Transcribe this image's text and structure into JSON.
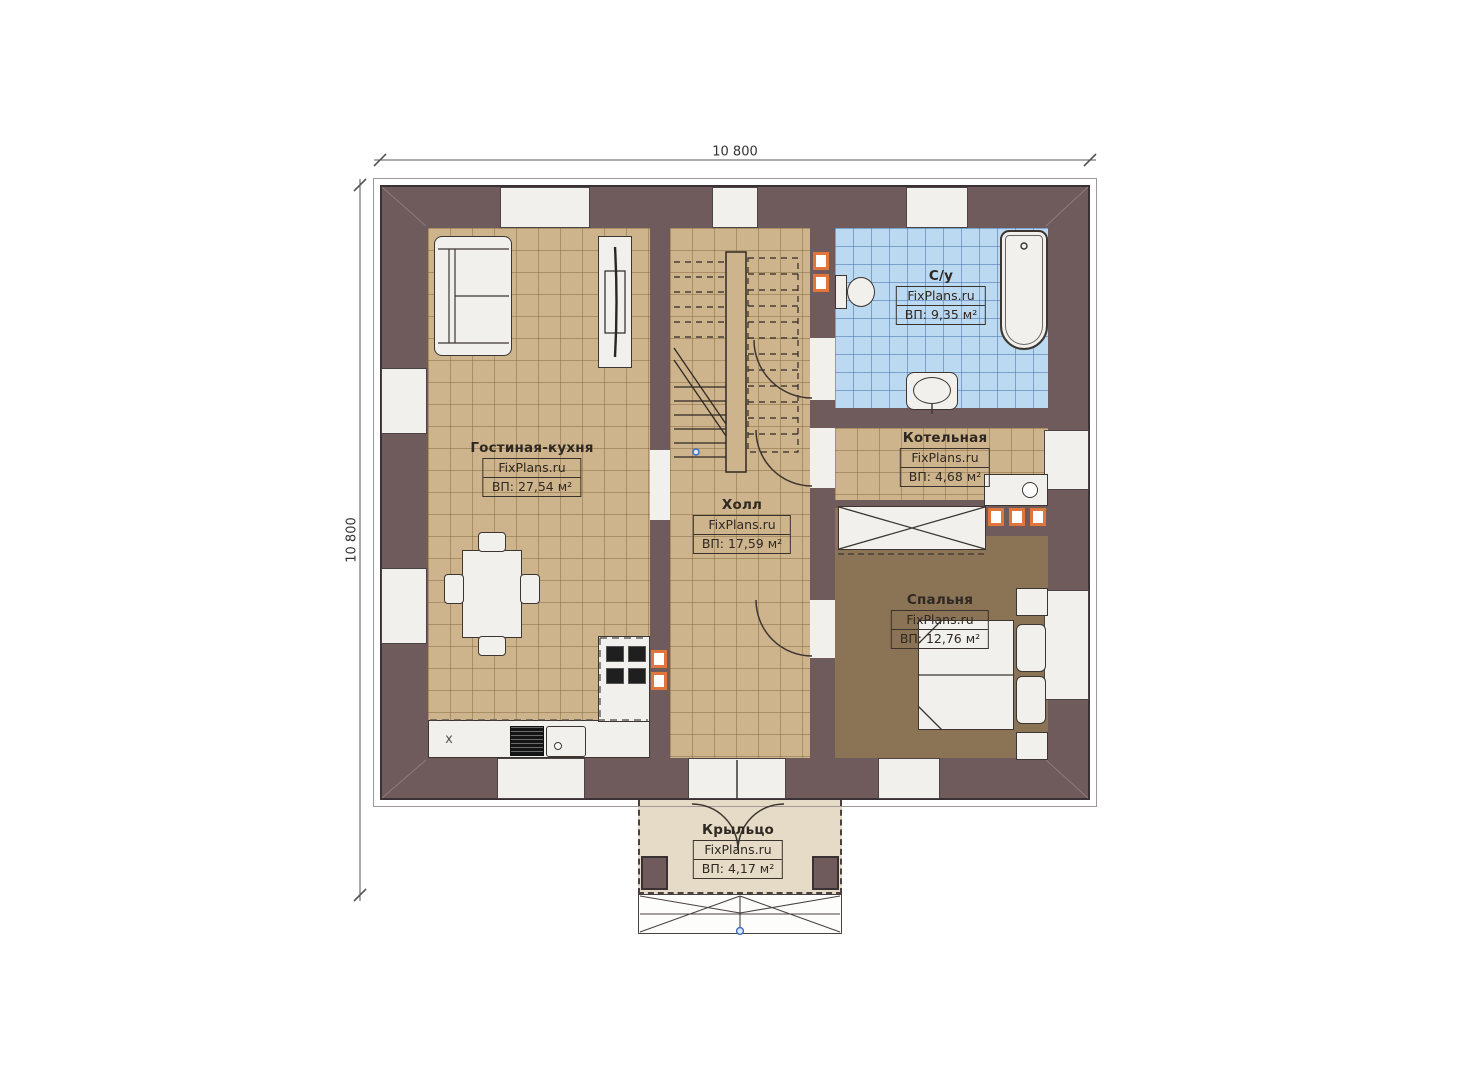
{
  "dimensions": {
    "top": "10 800",
    "left": "10 800"
  },
  "watermark": "FixPlans.ru",
  "rooms": [
    {
      "name": "Гостиная-кухня",
      "area": "ВП: 27,54 м²"
    },
    {
      "name": "Холл",
      "area": "ВП: 17,59 м²"
    },
    {
      "name": "С/у",
      "area": "ВП: 9,35 м²"
    },
    {
      "name": "Котельная",
      "area": "ВП: 4,68 м²"
    },
    {
      "name": "Спальня",
      "area": "ВП: 12,76 м²"
    },
    {
      "name": "Крыльцо",
      "area": "ВП: 4,17 м²"
    }
  ],
  "symbols": {
    "cabinet_x": "x"
  },
  "colors": {
    "wall": "#6f5a5c",
    "wallline": "#3a3134",
    "floor": "#cdb48c",
    "bath": "#bcd9f2",
    "bedroom": "#8b7356",
    "porch": "#e6dbc7",
    "fixture": "#f1f0ed",
    "outline": "#454040",
    "accent": "#e0763c",
    "ink": "#2f2822",
    "dim": "#555555",
    "blue": "#3a6bc4"
  }
}
